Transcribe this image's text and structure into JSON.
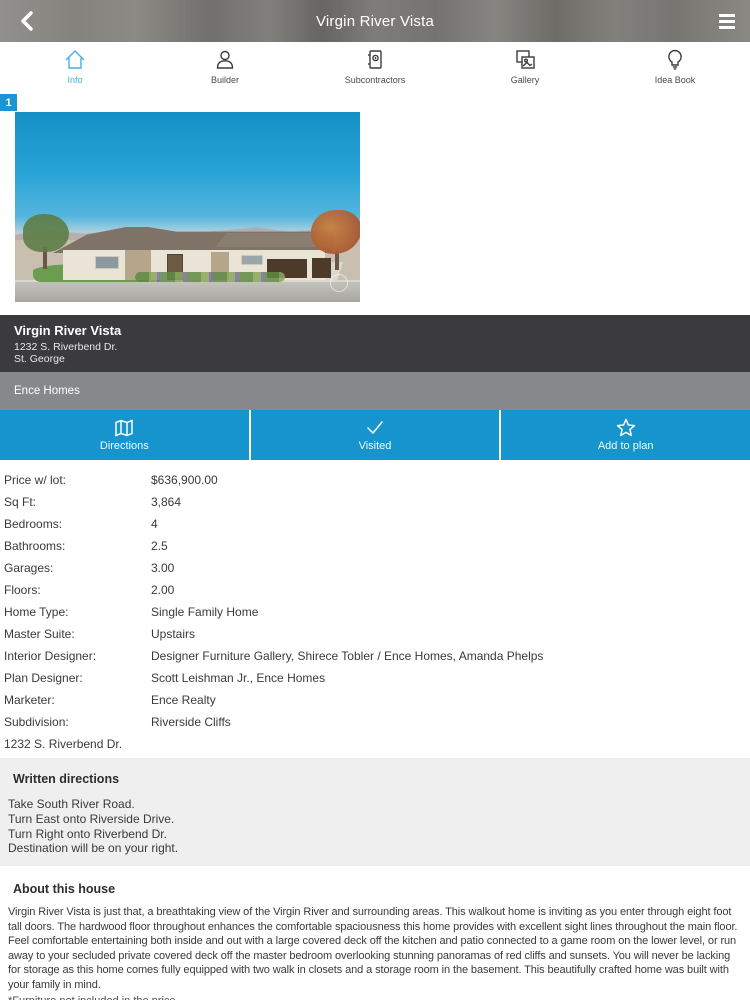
{
  "header": {
    "title": "Virgin River Vista",
    "back_icon": "chevron-left-icon",
    "menu_icon": "hamburger-menu-icon"
  },
  "tabs": [
    {
      "label": "Info",
      "icon": "house-icon",
      "active": true
    },
    {
      "label": "Builder",
      "icon": "person-icon",
      "active": false
    },
    {
      "label": "Subcontractors",
      "icon": "contact-book-icon",
      "active": false
    },
    {
      "label": "Gallery",
      "icon": "photos-icon",
      "active": false
    },
    {
      "label": "Idea Book",
      "icon": "lightbulb-icon",
      "active": false
    }
  ],
  "photo": {
    "badge_count": "1",
    "description": "rendering of a single-story stucco home with three-car garage under blue sky"
  },
  "listing": {
    "name": "Virgin River Vista",
    "address_line1": "1232 S. Riverbend Dr.",
    "address_line2": "St. George",
    "builder": "Ence Homes"
  },
  "actions": [
    {
      "label": "Directions",
      "icon": "map-icon"
    },
    {
      "label": "Visited",
      "icon": "check-icon"
    },
    {
      "label": "Add to plan",
      "icon": "star-icon"
    }
  ],
  "details": {
    "rows": [
      {
        "label": "Price w/ lot:",
        "value": "$636,900.00"
      },
      {
        "label": "Sq Ft:",
        "value": "3,864"
      },
      {
        "label": "Bedrooms:",
        "value": "4"
      },
      {
        "label": "Bathrooms:",
        "value": "2.5"
      },
      {
        "label": "Garages:",
        "value": "3.00"
      },
      {
        "label": "Floors:",
        "value": "2.00"
      },
      {
        "label": "Home Type:",
        "value": "Single Family Home"
      },
      {
        "label": "Master Suite:",
        "value": "Upstairs"
      },
      {
        "label": "Interior Designer:",
        "value": "Designer Furniture Gallery, Shirece Tobler / Ence Homes, Amanda Phelps"
      },
      {
        "label": "Plan Designer:",
        "value": "Scott Leishman Jr., Ence Homes"
      },
      {
        "label": "Marketer:",
        "value": "Ence Realty"
      },
      {
        "label": "Subdivision:",
        "value": "Riverside Cliffs"
      }
    ]
  },
  "address_footer": "1232 S. Riverbend Dr.",
  "directions": {
    "heading": "Written directions",
    "lines": [
      "Take South River Road.",
      "Turn East onto Riverside Drive.",
      "Turn Right onto Riverbend Dr.",
      "Destination will be on your right."
    ]
  },
  "about": {
    "heading": "About this house",
    "body": "Virgin River Vista is just that, a breathtaking view of the Virgin River and surrounding areas. This walkout home is inviting as you enter through eight foot tall doors. The hardwood floor throughout enhances the comfortable spaciousness this home provides with excellent sight lines throughout the main floor. Feel comfortable entertaining both inside and out with a large covered deck off the kitchen and patio connected to a game room on the lower level, or run away to your secluded private covered deck off the master bedroom overlooking stunning panoramas of red cliffs and sunsets. You will never be lacking for storage as this home comes fully equipped with two walk in closets and a storage room in the basement. This beautifully crafted home was built with your family in mind.",
    "footnote": "*Furniture not included in the price"
  },
  "colors": {
    "accent_blue": "#1694ce",
    "tab_active_blue": "#41b0e3",
    "badge_blue": "#1d95d3",
    "dark_bar": "#3b3b3d",
    "gray_bar": "#87888b",
    "directions_box_bg": "#efefef"
  }
}
